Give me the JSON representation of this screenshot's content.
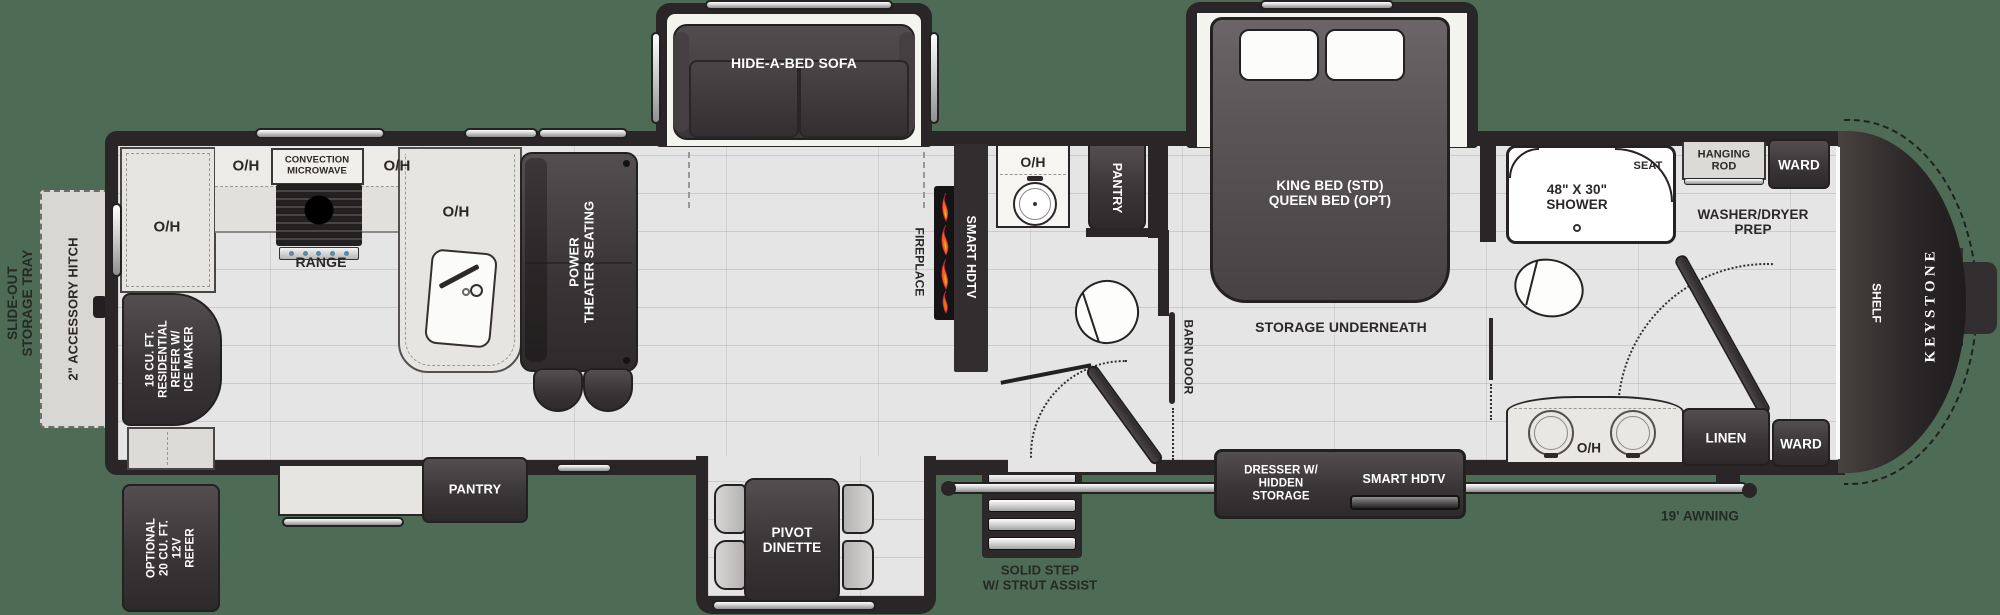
{
  "colors": {
    "background": "#4e6b55",
    "wall": "#2a2627",
    "floor": "#e5e5e6",
    "dark_furniture": "#3a3536",
    "flame_orange": "#f26722",
    "flame_yellow": "#fdb515"
  },
  "rear_exterior": {
    "storage_tray": "SLIDE-OUT\nSTORAGE TRAY",
    "accessory_hitch": "2\" ACCESSORY HITCH",
    "optional_refer": "OPTIONAL\n20 CU. FT.\n12V\nREFER"
  },
  "kitchen": {
    "oh_rear": "O/H",
    "oh_left": "O/H",
    "microwave": "CONVECTION\nMICROWAVE",
    "oh_right": "O/H",
    "range": "RANGE",
    "oh_sink": "O/H",
    "refer": "18 CU. FT.\nRESIDENTIAL\nREFER W/\nICE MAKER",
    "pantry": "PANTRY"
  },
  "living": {
    "theater": "POWER\nTHEATER SEATING",
    "sofa": "HIDE-A-BED SOFA",
    "fireplace": "FIREPLACE",
    "smart_hdtv": "SMART HDTV",
    "dinette": "PIVOT\nDINETTE"
  },
  "mid_bath": {
    "oh": "O/H",
    "pantry": "PANTRY",
    "barn_door": "BARN DOOR"
  },
  "entry": {
    "step": "SOLID STEP\nW/ STRUT ASSIST",
    "awning": "19' AWNING"
  },
  "bedroom": {
    "bed": "KING BED (STD)\nQUEEN BED (OPT)",
    "storage": "STORAGE UNDERNEATH",
    "dresser": "DRESSER W/\nHIDDEN\nSTORAGE",
    "smart_hdtv": "SMART HDTV"
  },
  "front_bath": {
    "shower": "48\" X 30\"\nSHOWER",
    "seat": "SEAT",
    "hanging_rod": "HANGING\nROD",
    "ward_top": "WARD",
    "washer_dryer": "WASHER/DRYER\nPREP",
    "oh": "O/H",
    "linen": "LINEN",
    "ward_bottom": "WARD"
  },
  "front_cap": {
    "shelf": "SHELF",
    "brand": "KEYSTONE"
  }
}
